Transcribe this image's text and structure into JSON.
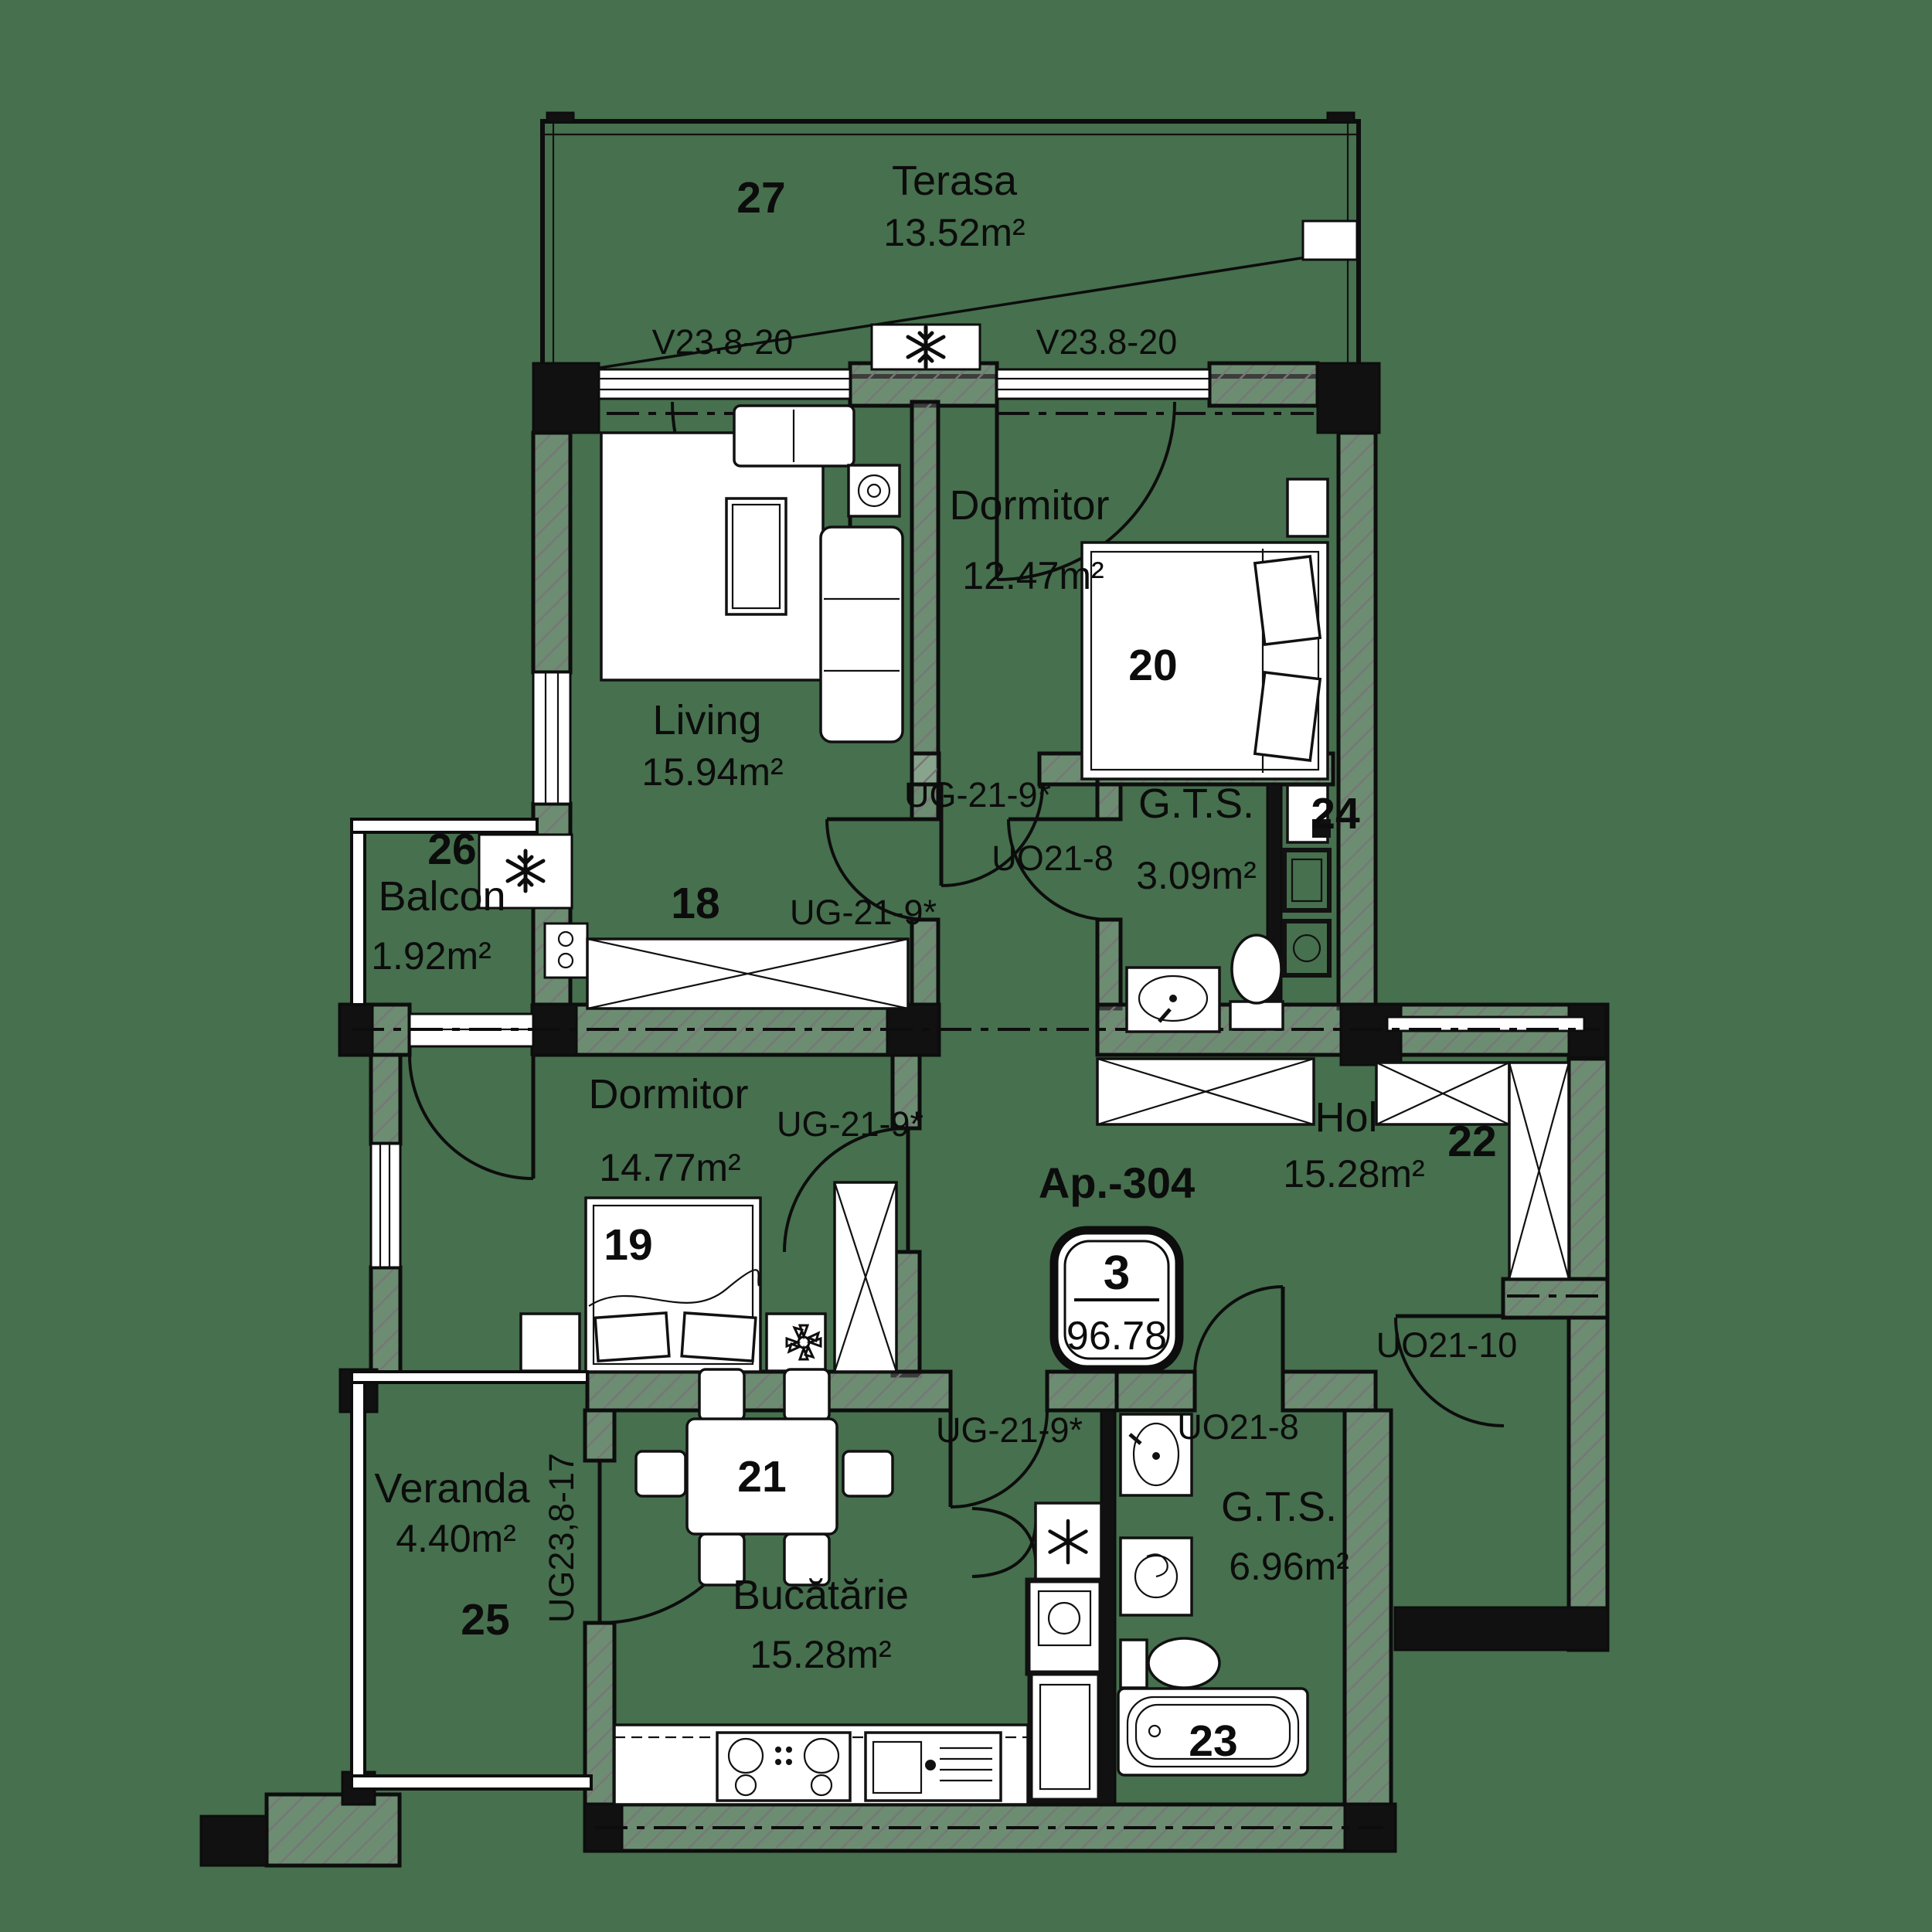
{
  "plan": {
    "colors": {
      "background": "#47704E",
      "line": "#0d0d0d",
      "paper": "#ffffff"
    },
    "apartment": {
      "label": "Ap.-304",
      "unit_number": "3",
      "total_area": "96.78"
    },
    "rooms": [
      {
        "num": "27",
        "name": "Terasa",
        "area": "13.52m²"
      },
      {
        "num": "20",
        "name": "Dormitor",
        "area": "12.47m²"
      },
      {
        "num": "18",
        "name": "Living",
        "area": "15.94m²"
      },
      {
        "num": "26",
        "name": "Balcon",
        "area": "1.92m²"
      },
      {
        "num": "24",
        "name": "G.T.S.",
        "area": "3.09m²"
      },
      {
        "num": "19",
        "name": "Dormitor",
        "area": "14.77m²"
      },
      {
        "num": "22",
        "name": "Hol",
        "area": "15.28m²"
      },
      {
        "num": "25",
        "name": "Veranda",
        "area": "4.40m²"
      },
      {
        "num": "21",
        "name": "Bucătărie",
        "area": "15.28m²"
      },
      {
        "num": "23",
        "name": "G.T.S.",
        "area": "6.96m²"
      }
    ],
    "openings": {
      "window_top_left": "V23.8-20",
      "window_top_right": "V23.8-20",
      "door_dormitor1": "UG-21-9*",
      "door_living": "UG-21-9*",
      "door_dormitor2": "UG-21-9*",
      "door_bucatarie": "UG-21-9*",
      "door_gts1": "UO21-8",
      "door_gts2": "UO21-8",
      "door_entrance": "UO21-10",
      "door_veranda": "UG23,8-17"
    }
  }
}
